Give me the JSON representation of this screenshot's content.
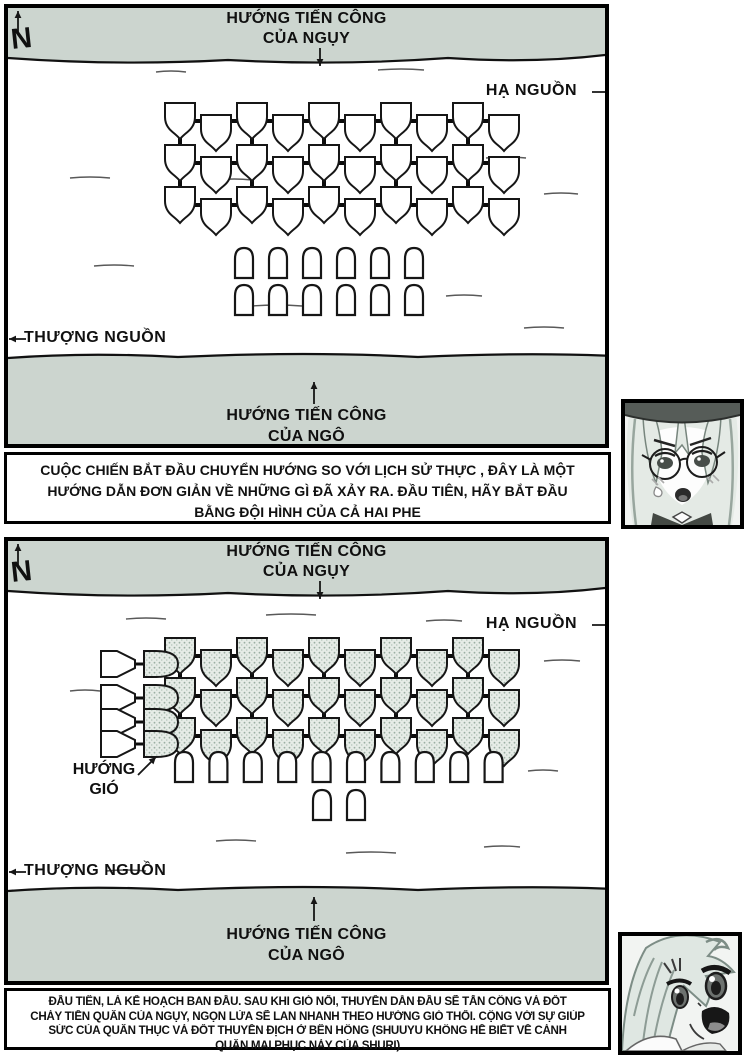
{
  "colors": {
    "ink": "#161616",
    "bank": "#ccd5cf",
    "ship_fill": "#ffffff",
    "shaded_fill": "#e6ece7",
    "speckle": "#9bafa3",
    "paper": "#ffffff"
  },
  "panel1": {
    "compass": "N",
    "attack_top_line1": "HƯỚNG TIẾN CÔNG",
    "attack_top_line2": "CỦA NGỤY",
    "downstream": "HẠ NGUỒN",
    "upstream": "THƯỢNG NGUỒN",
    "attack_bottom_line1": "HƯỚNG TIẾN CÔNG",
    "attack_bottom_line2": "CỦA NGÔ"
  },
  "panel2": {
    "compass": "N",
    "attack_top_line1": "HƯỚNG TIẾN CÔNG",
    "attack_top_line2": "CỦA NGỤY",
    "downstream": "HẠ NGUỒN",
    "upstream": "THƯỢNG NGUỒN",
    "attack_bottom_line1": "HƯỚNG TIẾN CÔNG",
    "attack_bottom_line2": "CỦA NGÔ",
    "wind_line1": "HƯỚNG",
    "wind_line2": "GIÓ"
  },
  "caption1": {
    "lines": [
      "CUỘC CHIẾN BẮT ĐẦU CHUYỂN HƯỚNG SO VỚI LỊCH SỬ THỰC , ĐÂY LÀ MỘT",
      "HƯỚNG DẪN ĐƠN GIẢN VỀ NHỮNG GÌ ĐÃ XẢY RA. ĐẦU TIÊN, HÃY BẮT ĐẦU",
      "BẰNG ĐỘI HÌNH CỦA CẢ HAI PHE"
    ]
  },
  "caption2": {
    "lines": [
      "ĐẦU TIÊN, LÀ KẾ HOẠCH BAN ĐẦU. SAU KHI GIÓ NỔI, THUYỀN DẪN ĐẦU SẼ TẤN CÔNG VÀ ĐỐT",
      "CHÁY  TIỀN QUÂN CỦA NGỤY, NGỌN LỬA SẼ LAN NHANH THEO HƯỚNG GIÓ THỔI. CỘNG VỚI SỰ GIÚP",
      "SỨC CỦA QUÂN THỤC VÀ ĐỐT  THUYỀN ĐỊCH Ở BÊN HÔNG (SHUUYU KHÔNG HỀ BIẾT VỀ CÁNH",
      "QUÂN MAI PHỤC NÀY CỦA SHURI)"
    ]
  },
  "formation": {
    "wei_fleet": {
      "chain_rows": 3,
      "ships_per_row": 10,
      "shaded_in_panel2": true
    },
    "wu_fleet_panel1": {
      "rows": 2,
      "ships_per_row": 6
    },
    "wu_fleet_panel2": {
      "front_row_ships": 10,
      "rear_ships": 2
    },
    "fire_ship_pairs_panel2": 4
  }
}
